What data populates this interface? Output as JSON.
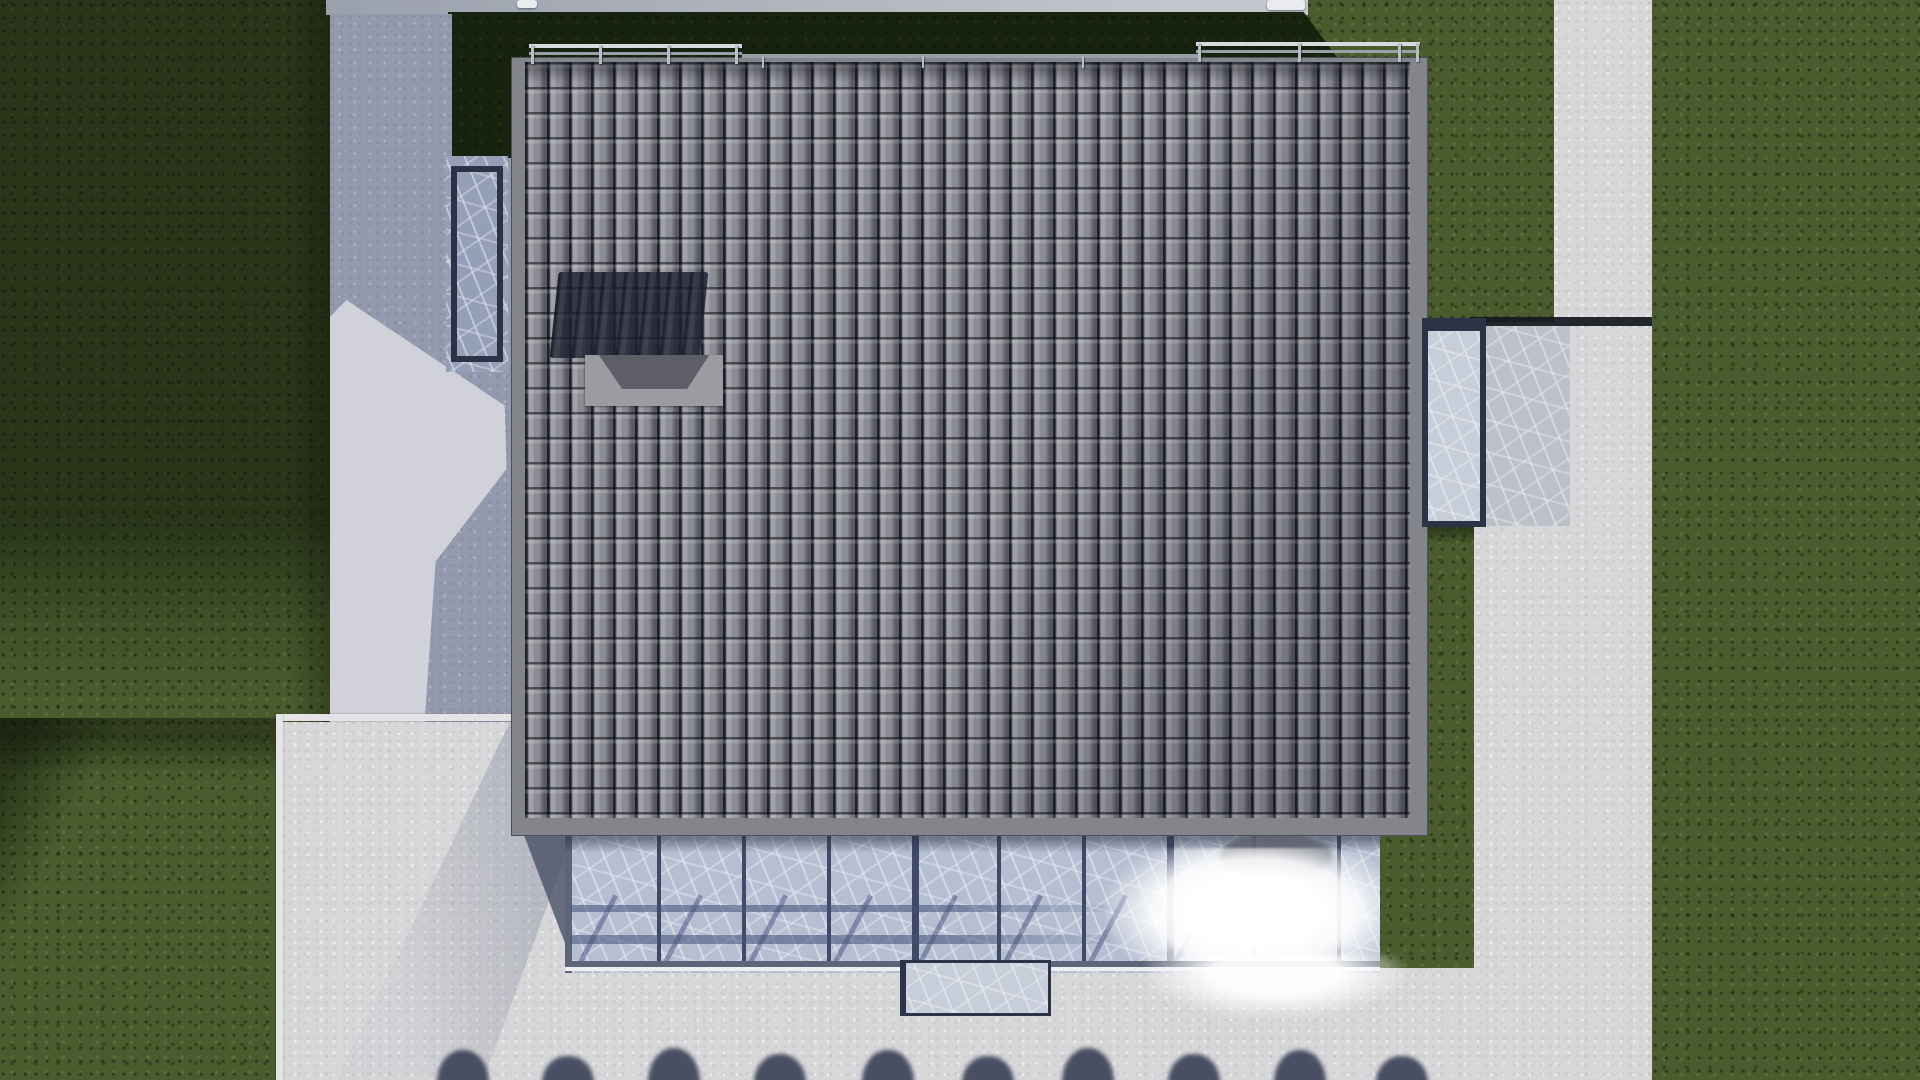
{
  "scene": {
    "description": "Aerial top-down 3D architectural rendering of a detached house with a dark grey barrel-tiled roof, rooftop chimney box casting a shadow, metal edge railings, a glass conservatory canopy with sun glare, frosted-glass skylight strips, concrete paths and terraces, and surrounding lawns with a row of tree shadows at the bottom edge",
    "view": "orthographic bird's-eye",
    "lighting": "strong sun from lower right, building shadow cast to upper left, bright specular glare on conservatory glass"
  },
  "palette": {
    "grass_base": "#4a5c2e",
    "grass_dark": "#18230f",
    "concrete_bright": "#d7d7d9",
    "concrete_band": "#9aa0ac",
    "concrete_shadow": "#949aad",
    "curb": "#e4e4e6",
    "roof_tile": "#8c8c94",
    "roof_border": "#84848b",
    "navy": "#2b3447",
    "mullion": "#3f4a66",
    "glass": "#b6bfd2",
    "glass_dark": "#95a0b8",
    "glass_light": "#c7ced9",
    "shadow_navy": "rgba(28,33,50,0.82)",
    "rail_light": "#d7dade",
    "rail_mid": "#99a0aa",
    "dark_line": "#15181f",
    "teal_dark": "#1f3028",
    "tree_shadow": "rgba(54,60,82,0.88)",
    "chimney": "#9b9ba1",
    "chimney_face": "#5e5e69",
    "glare": "#ffffff"
  },
  "regions": [
    {
      "name": "pavement-base",
      "cls": "concrete-bright",
      "x": 0,
      "y": 0,
      "w": 1920,
      "h": 1080
    },
    {
      "name": "lawn-left-upper",
      "cls": "grass shade-a",
      "x": 0,
      "y": 0,
      "w": 352,
      "h": 722
    },
    {
      "name": "lawn-left-lower",
      "cls": "grass shade-b",
      "x": 0,
      "y": 718,
      "w": 281,
      "h": 362
    },
    {
      "name": "lawn-top-right",
      "cls": "grass",
      "x": 1306,
      "y": 0,
      "w": 248,
      "h": 322
    },
    {
      "name": "lawn-right",
      "cls": "grass",
      "x": 1652,
      "y": 0,
      "w": 268,
      "h": 1080
    },
    {
      "name": "lawn-strip-east",
      "cls": "grass shade-top",
      "x": 1428,
      "y": 518,
      "w": 46,
      "h": 334
    },
    {
      "name": "lawn-notch-east",
      "cls": "grass",
      "x": 1376,
      "y": 836,
      "w": 98,
      "h": 132
    },
    {
      "name": "path-top-band",
      "cls": "concrete-band",
      "x": 326,
      "y": 0,
      "w": 982,
      "h": 15
    },
    {
      "name": "shadow-lawn-band-north",
      "cls": "grass-dark",
      "x": 450,
      "y": 12,
      "w": 892,
      "h": 52,
      "clip": "polygon(0 0, 95.7% 0, 100% 100%, 0 100%)"
    },
    {
      "name": "shadow-lawn-strip-west",
      "cls": "grass-dark",
      "x": 448,
      "y": 12,
      "w": 64,
      "h": 150
    },
    {
      "name": "path-west",
      "cls": "concrete-shadow",
      "x": 330,
      "y": 14,
      "w": 122,
      "h": 708
    },
    {
      "name": "path-west-inner",
      "cls": "concrete-shadow",
      "x": 450,
      "y": 158,
      "w": 62,
      "h": 564
    },
    {
      "name": "path-west-light-patch",
      "cls": "concrete-patch",
      "x": 330,
      "y": 300,
      "w": 182,
      "h": 422,
      "clip": "polygon(9% 0, 96% 25%, 97% 40%, 58% 62%, 52% 100%, 0 100%, 0 4%)"
    },
    {
      "name": "terrace-curb-horizontal",
      "cls": "curb",
      "x": 276,
      "y": 714,
      "w": 242,
      "h": 7
    },
    {
      "name": "terrace-curb-vertical",
      "cls": "curb",
      "x": 276,
      "y": 714,
      "w": 7,
      "h": 366
    },
    {
      "name": "terrace-soft-shadow",
      "cls": "soft-shadow",
      "x": 316,
      "y": 721,
      "w": 270,
      "h": 359,
      "clip": "polygon(72% 0, 100% 22%, 62% 100%, 8% 100%)"
    },
    {
      "name": "streaked-apron-east",
      "cls": "streaky-concrete streaky",
      "x": 1470,
      "y": 326,
      "w": 100,
      "h": 200
    },
    {
      "name": "shadow-line-east",
      "cls": "dark-line",
      "x": 1470,
      "y": 317,
      "w": 182,
      "h": 9
    },
    {
      "name": "walkway-under-shade",
      "cls": "teal-dark",
      "x": 1426,
      "y": 503,
      "w": 46,
      "h": 20
    }
  ],
  "roof": {
    "x": 512,
    "y": 58,
    "w": 915,
    "h": 777,
    "tiles": {
      "left": 13,
      "top": 4,
      "right": 17,
      "bottom": 17,
      "col": 22,
      "row": 25
    },
    "chimney_shadow": {
      "x": 42,
      "y": 214,
      "w": 150,
      "h": 86
    },
    "chimney": {
      "x": 73,
      "y": 297,
      "w": 138,
      "h": 51
    }
  },
  "railings": [
    {
      "name": "railing-northwest",
      "x": 529,
      "y": 44,
      "w": 213,
      "posts": [
        2,
        70,
        138,
        206
      ]
    },
    {
      "name": "railing-northeast",
      "x": 1196,
      "y": 42,
      "w": 224,
      "posts": [
        2,
        102,
        202,
        220
      ]
    }
  ],
  "mid_rail": {
    "x": 742,
    "y": 54,
    "w": 456,
    "h": 4,
    "ticks": [
      20,
      180,
      340
    ]
  },
  "window_west": {
    "x": 446,
    "y": 156,
    "w": 62,
    "h": 216
  },
  "walkway_east": {
    "x": 1422,
    "y": 318,
    "w": 52,
    "h": 190
  },
  "conservatory": {
    "x": 565,
    "y": 833,
    "w": 815,
    "h": 140,
    "left_frame_w": 7,
    "mullions": [
      92,
      177,
      262,
      347,
      432,
      517,
      602,
      687,
      772
    ],
    "thick_mullions": [
      347,
      602
    ],
    "shadow_bars": [
      {
        "y": 72,
        "h": 7
      },
      {
        "y": 102,
        "h": 9
      }
    ],
    "diagonals": [
      30,
      115,
      200,
      285,
      370,
      455,
      540,
      625
    ],
    "bottom_frame_y": 128,
    "glare": {
      "x": 540,
      "y": 15,
      "w": 300,
      "h": 140
    },
    "palm": {
      "x": 655,
      "y": 0,
      "w": 112,
      "h": 46
    }
  },
  "conservatory_wedge": {
    "x": 512,
    "y": 833,
    "w": 62,
    "h": 134,
    "clip": "polygon(18% 0, 100% 3%, 100% 100%)"
  },
  "glare_spill": {
    "x": 1145,
    "y": 955,
    "w": 260,
    "h": 62
  },
  "bay_window_south": {
    "x": 900,
    "y": 960,
    "w": 142,
    "h": 50
  },
  "under_roof_shadow_line": {
    "x": 512,
    "y": 831,
    "w": 915,
    "h": 4
  },
  "tree_shadows": {
    "y": 1052,
    "width": 52,
    "centers": [
      463,
      568,
      674,
      780,
      888,
      988,
      1088,
      1194,
      1300,
      1402
    ],
    "heights": [
      30,
      24,
      32,
      26,
      30,
      24,
      32,
      26,
      30,
      24
    ]
  },
  "top_objects": [
    {
      "name": "rooftop-vent-object-west",
      "x": 517,
      "y": 0,
      "w": 20,
      "h": 8
    },
    {
      "name": "rooftop-vent-object-east",
      "x": 1267,
      "y": 0,
      "w": 38,
      "h": 10
    }
  ]
}
